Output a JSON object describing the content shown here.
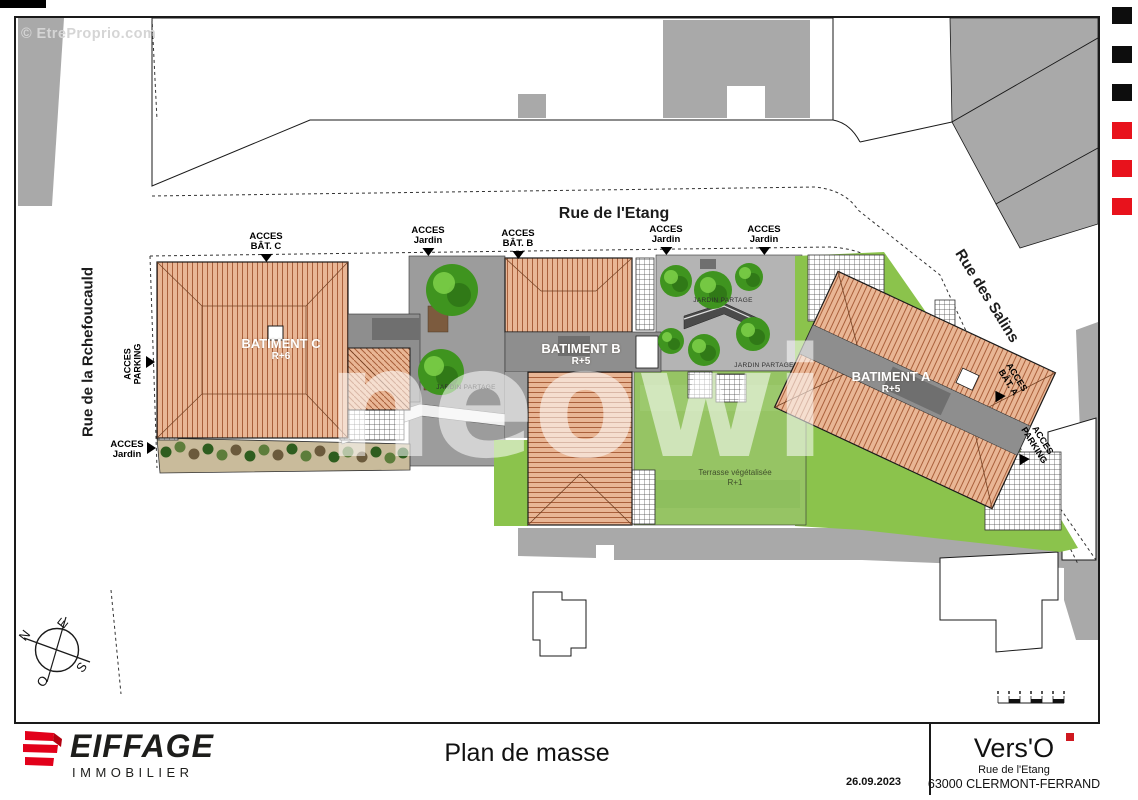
{
  "watermarks": {
    "corner": "© EtreProprio.com",
    "brand": "neowi"
  },
  "streets": {
    "etang": "Rue de l'Etang",
    "rochefoucauld": "Rue de la Rchefoucauld",
    "salins": "Rue des Salins"
  },
  "access": {
    "bat_c": {
      "l1": "ACCES",
      "l2": "BÂT. C"
    },
    "jardin_top_1": {
      "l1": "ACCES",
      "l2": "Jardin"
    },
    "bat_b": {
      "l1": "ACCES",
      "l2": "BÂT. B"
    },
    "jardin_top_2": {
      "l1": "ACCES",
      "l2": "Jardin"
    },
    "jardin_top_3": {
      "l1": "ACCES",
      "l2": "Jardin"
    },
    "parking_west": {
      "l1": "ACCES",
      "l2": "PARKING"
    },
    "jardin_west": {
      "l1": "ACCES",
      "l2": "Jardin"
    },
    "bat_a": {
      "l1": "ACCES",
      "l2": "BÂT. A"
    },
    "parking_east": {
      "l1": "ACCES",
      "l2": "PARKING"
    }
  },
  "buildings": {
    "c": {
      "name": "BATIMENT C",
      "level": "R+6"
    },
    "b": {
      "name": "BATIMENT B",
      "level": "R+5"
    },
    "a": {
      "name": "BATIMENT A",
      "level": "R+5"
    }
  },
  "site": {
    "jardin_partage": "JARDIN PARTAGE",
    "terrasse_l1": "Terrasse végétalisée",
    "terrasse_l2": "R+1"
  },
  "compass": {
    "n": "N",
    "e": "E",
    "s": "S",
    "o": "O"
  },
  "title_block": {
    "company": "EIFFAGE",
    "division": "IMMOBILIER",
    "drawing_title": "Plan de masse",
    "date": "26.09.2023",
    "project_name": "Vers'O",
    "project_street": "Rue de l'Etang",
    "project_city": "63000 CLERMONT-FERRAND"
  },
  "colors": {
    "marker_black": "#0d0d0d",
    "marker_red": "#e8121c",
    "logo_red": "#e2001a",
    "roof_fill": "#e9b695",
    "roof_line": "#aa603b",
    "lawn_green": "#8bc34c",
    "terrace_green": "#96c464",
    "road_gray": "#a9a9a9",
    "flat_roof_gray": "#8e8e8e"
  }
}
